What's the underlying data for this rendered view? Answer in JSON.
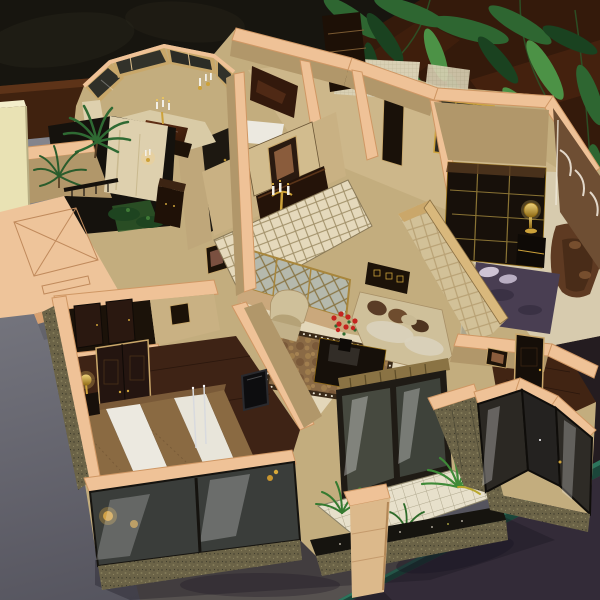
{
  "image": {
    "width": 600,
    "height": 600,
    "kind": "photograph",
    "description": "High-angle photograph of a miniature luxury-apartment architectural scale model (cutaway floor-plan maquette) displayed on a gray table, with dark drapery, a dark brown wooden shelf and overhanging green houseplant palm leaves behind it."
  },
  "scene": {
    "background": {
      "drapery": "very dark patterned curtain, upper left",
      "shelf": "glossy dark reddish-brown wood surface behind and right of the model",
      "plant": "large green palm / bamboo-palm leaves overhanging the top right corner"
    },
    "display_surface": {
      "table": "matte gray table top, lighter at left, darker toward bottom",
      "edge_strip": "dark green beveled table edge crossing the bottom-right corner",
      "shadows": "soft leaf and model shadows cast on the gray surface"
    },
    "model": {
      "style": "luxury apartment interior model; walls cut flat with peach/tan painted top edges; khaki textured wall faces; olive speckled granite exterior walls",
      "roof_marking": "flat roof slab at left engraved with a rectangle crossed by an X and a small bar (shaft symbol)",
      "rooms": [
        {
          "name": "octagonal-dining-bay",
          "features": [
            "wood-framed glazed bay windows",
            "glossy dark dining table",
            "gold candelabra",
            "gold wall sconces with white candles"
          ]
        },
        {
          "name": "atrium-courtyard",
          "features": [
            "two miniature palm trees",
            "light marble feature wall",
            "gold sconce",
            "dark wood cabinet",
            "black railing",
            "green shrubs"
          ]
        },
        {
          "name": "entry-hall",
          "features": [
            "dark polished stone floor with gold glints",
            "framed oil painting",
            "gold candelabra sconce",
            "dark sideboard",
            "diamond-pattern marble floor"
          ]
        },
        {
          "name": "bathroom-block",
          "features": [
            "beige mosaic tiled walls",
            "gold-framed glass shower enclosure",
            "tall dark wardrobe",
            "white floor mat"
          ]
        },
        {
          "name": "study",
          "features": [
            "black display bookcase with gold trim grid",
            "gold table lamp on black side table",
            "brown leather chesterfield sofa",
            "brown suede wall with white arched moldings"
          ]
        },
        {
          "name": "bedroom-right",
          "features": [
            "purple velvet quilted bed",
            "light pillows",
            "cream quilted leather headboard wall",
            "glass nightstand with crystal lamp"
          ]
        },
        {
          "name": "living-room",
          "features": [
            "gold lattice glass screen",
            "brown shag rug with dark bordered edge",
            "black coffee table",
            "red flower centerpiece in black vase",
            "cream armchair",
            "cream sofa with brown pillows",
            "dark sideboard with gold squares",
            "dark fireplace / TV panel on side wall"
          ]
        },
        {
          "name": "master-bedroom",
          "features": [
            "bed with white duvet and brown fur runners",
            "gold bedside lamp on dark nightstand",
            "tall dark double entry doors",
            "closet with two dark doors",
            "wall-mounted TV",
            "thin metal floor-lamp poles"
          ]
        },
        {
          "name": "balcony-terrace",
          "features": [
            "white tiled floor",
            "three green potted ferns",
            "dark planter railing with tiny white flowers",
            "stone pillar with peach cap",
            "large sliding glass doors with bright reflections"
          ]
        },
        {
          "name": "bay-window-room",
          "features": [
            "faceted dark-glass bay window",
            "dark wood plank floor",
            "dark paneled door",
            "small framed picture",
            "bronze/gold figurines"
          ]
        }
      ],
      "adjacent_structure": "pale yellow neighboring model block at far left edge"
    }
  },
  "palette": {
    "curtain": "#17150f",
    "curtainLight": "#2a271c",
    "ledgeWood": "#40220f",
    "ledgeWoodLight": "#6a3a1d",
    "woodSurface": "#341a0b",
    "woodGloss": "#5c2e14",
    "leafDark": "#1a4220",
    "leafMid": "#2e6631",
    "leafLight": "#4c9246",
    "tableGrayLight": "#81828a",
    "tableGrayDark": "#55545e",
    "tableWarm": "#57514c",
    "tableDark": "#332b38",
    "edgeGreen": "#1b463a",
    "edgeGreenHi": "#2f7a60",
    "wallTop": "#efc297",
    "wallTopShade": "#cf9764",
    "wallFace": "#c9b183",
    "wallFaceDim": "#b1976a",
    "marbleFloor": "#e5d9bc",
    "marbleWall": "#ded0ae",
    "granite": "#6b6347",
    "graniteDark": "#4e4a36",
    "floorWood": "#3e2315",
    "furnitureDark": "#1d1208",
    "glassDark": "#34352e",
    "frameWood": "#c8a76a",
    "gold": "#cda23a",
    "goldDeep": "#8f6a14",
    "cream": "#d2c198",
    "creamBright": "#ece9e0",
    "fur": "#8a6a42",
    "rugBase": "#8a6a45",
    "flowerRed": "#c4241f",
    "bedPurple": "#493e52",
    "white": "#f2efe6",
    "paleYellow": "#e9e2b4"
  }
}
